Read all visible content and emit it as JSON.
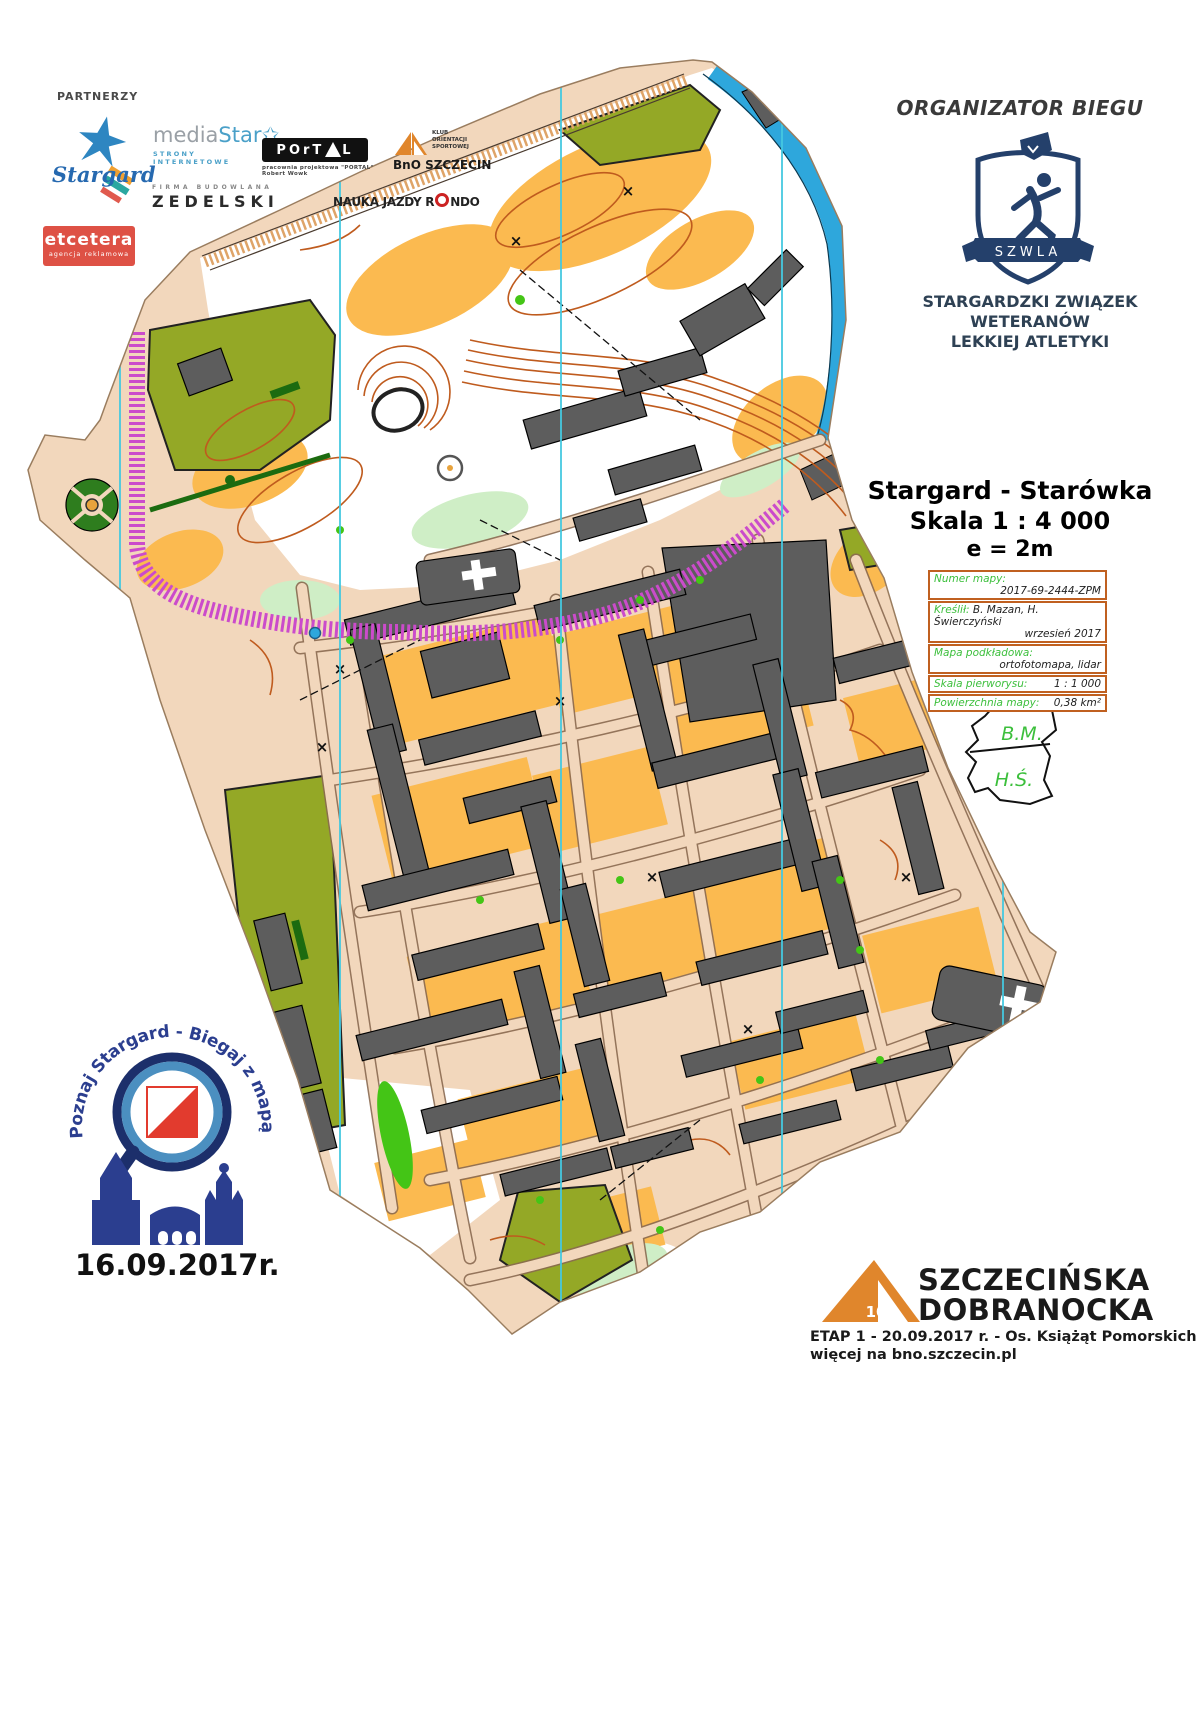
{
  "partners": {
    "heading": "PARTNERZY",
    "stargard": {
      "name": "Stargard"
    },
    "mediastar": {
      "name_gray": "media",
      "name_blue": "Star",
      "star_icon": "star-outline",
      "subtitle": "STRONY INTERNETOWE"
    },
    "portal": {
      "name_left": "POrT",
      "name_right": "L",
      "subtitle": "pracownia projektowa \"PORTAL\" Robert Wowk"
    },
    "bno_top": {
      "line1": "KLUB",
      "line2": "ORIENTACJI",
      "line3": "SPORTOWEJ",
      "name": "BnO SZCZECIN"
    },
    "zedelski": {
      "subtitle": "FIRMA BUDOWLANA",
      "name": "ZEDELSKI"
    },
    "rondo": {
      "name_pre": "NAUKA JAZDY R",
      "name_post": "NDO"
    },
    "etcetera": {
      "name": "etcetera",
      "subtitle": "agencja reklamowa"
    }
  },
  "organizer": {
    "heading": "ORGANIZATOR BIEGU",
    "badge_text": "SZWLA",
    "name_line1": "STARGARDZKI ZWIĄZEK",
    "name_line2": "WETERANÓW",
    "name_line3": "LEKKIEJ ATLETYKI"
  },
  "map_title": {
    "line1": "Stargard - Starówka",
    "line2": "Skala 1 : 4 000",
    "line3": "e = 2m"
  },
  "map_info": {
    "rows": [
      {
        "label": "Numer mapy:",
        "value": "2017-69-2444-ZPM"
      },
      {
        "label": "Kreślił:",
        "value": "B. Mazan, H. Świerczyński",
        "value2": "wrzesień 2017"
      },
      {
        "label": "Mapa podkładowa:",
        "value": "ortofotomapa, lidar"
      },
      {
        "label": "Skala pierworysu:",
        "value": "1 : 1 000"
      },
      {
        "label": "Powierzchnia mapy:",
        "value": "0,38 km²"
      }
    ]
  },
  "signature": {
    "top": "B.M.",
    "bottom": "H.Ś."
  },
  "event_left": {
    "arc_text": "Poznaj Stargard - Biegaj z mapą",
    "date": "16.09.2017r."
  },
  "event_right": {
    "number": "10",
    "title_line1": "SZCZECIŃSKA",
    "title_line2": "DOBRANOCKA",
    "details_line1": "ETAP 1 - 20.09.2017 r. - Os. Książąt Pomorskich",
    "details_line2": "więcej na bno.szczecin.pl"
  },
  "colors": {
    "paved": "#f2d7bc",
    "open_orange": "#fbba50",
    "building_gray": "#5d5d5d",
    "olive_green": "#94a826",
    "bright_green": "#44c516",
    "light_green": "#cfeec6",
    "water_blue": "#2ea7dc",
    "north_line_cyan": "#45c8e0",
    "contour_brown": "#bf5b1e",
    "forbidden_magenta": "#cb4bcb",
    "navy": "#24406b",
    "club_orange": "#e0862c",
    "table_border": "#c06020",
    "label_green": "#3cbf3c",
    "etcetera_red": "#de5145"
  }
}
